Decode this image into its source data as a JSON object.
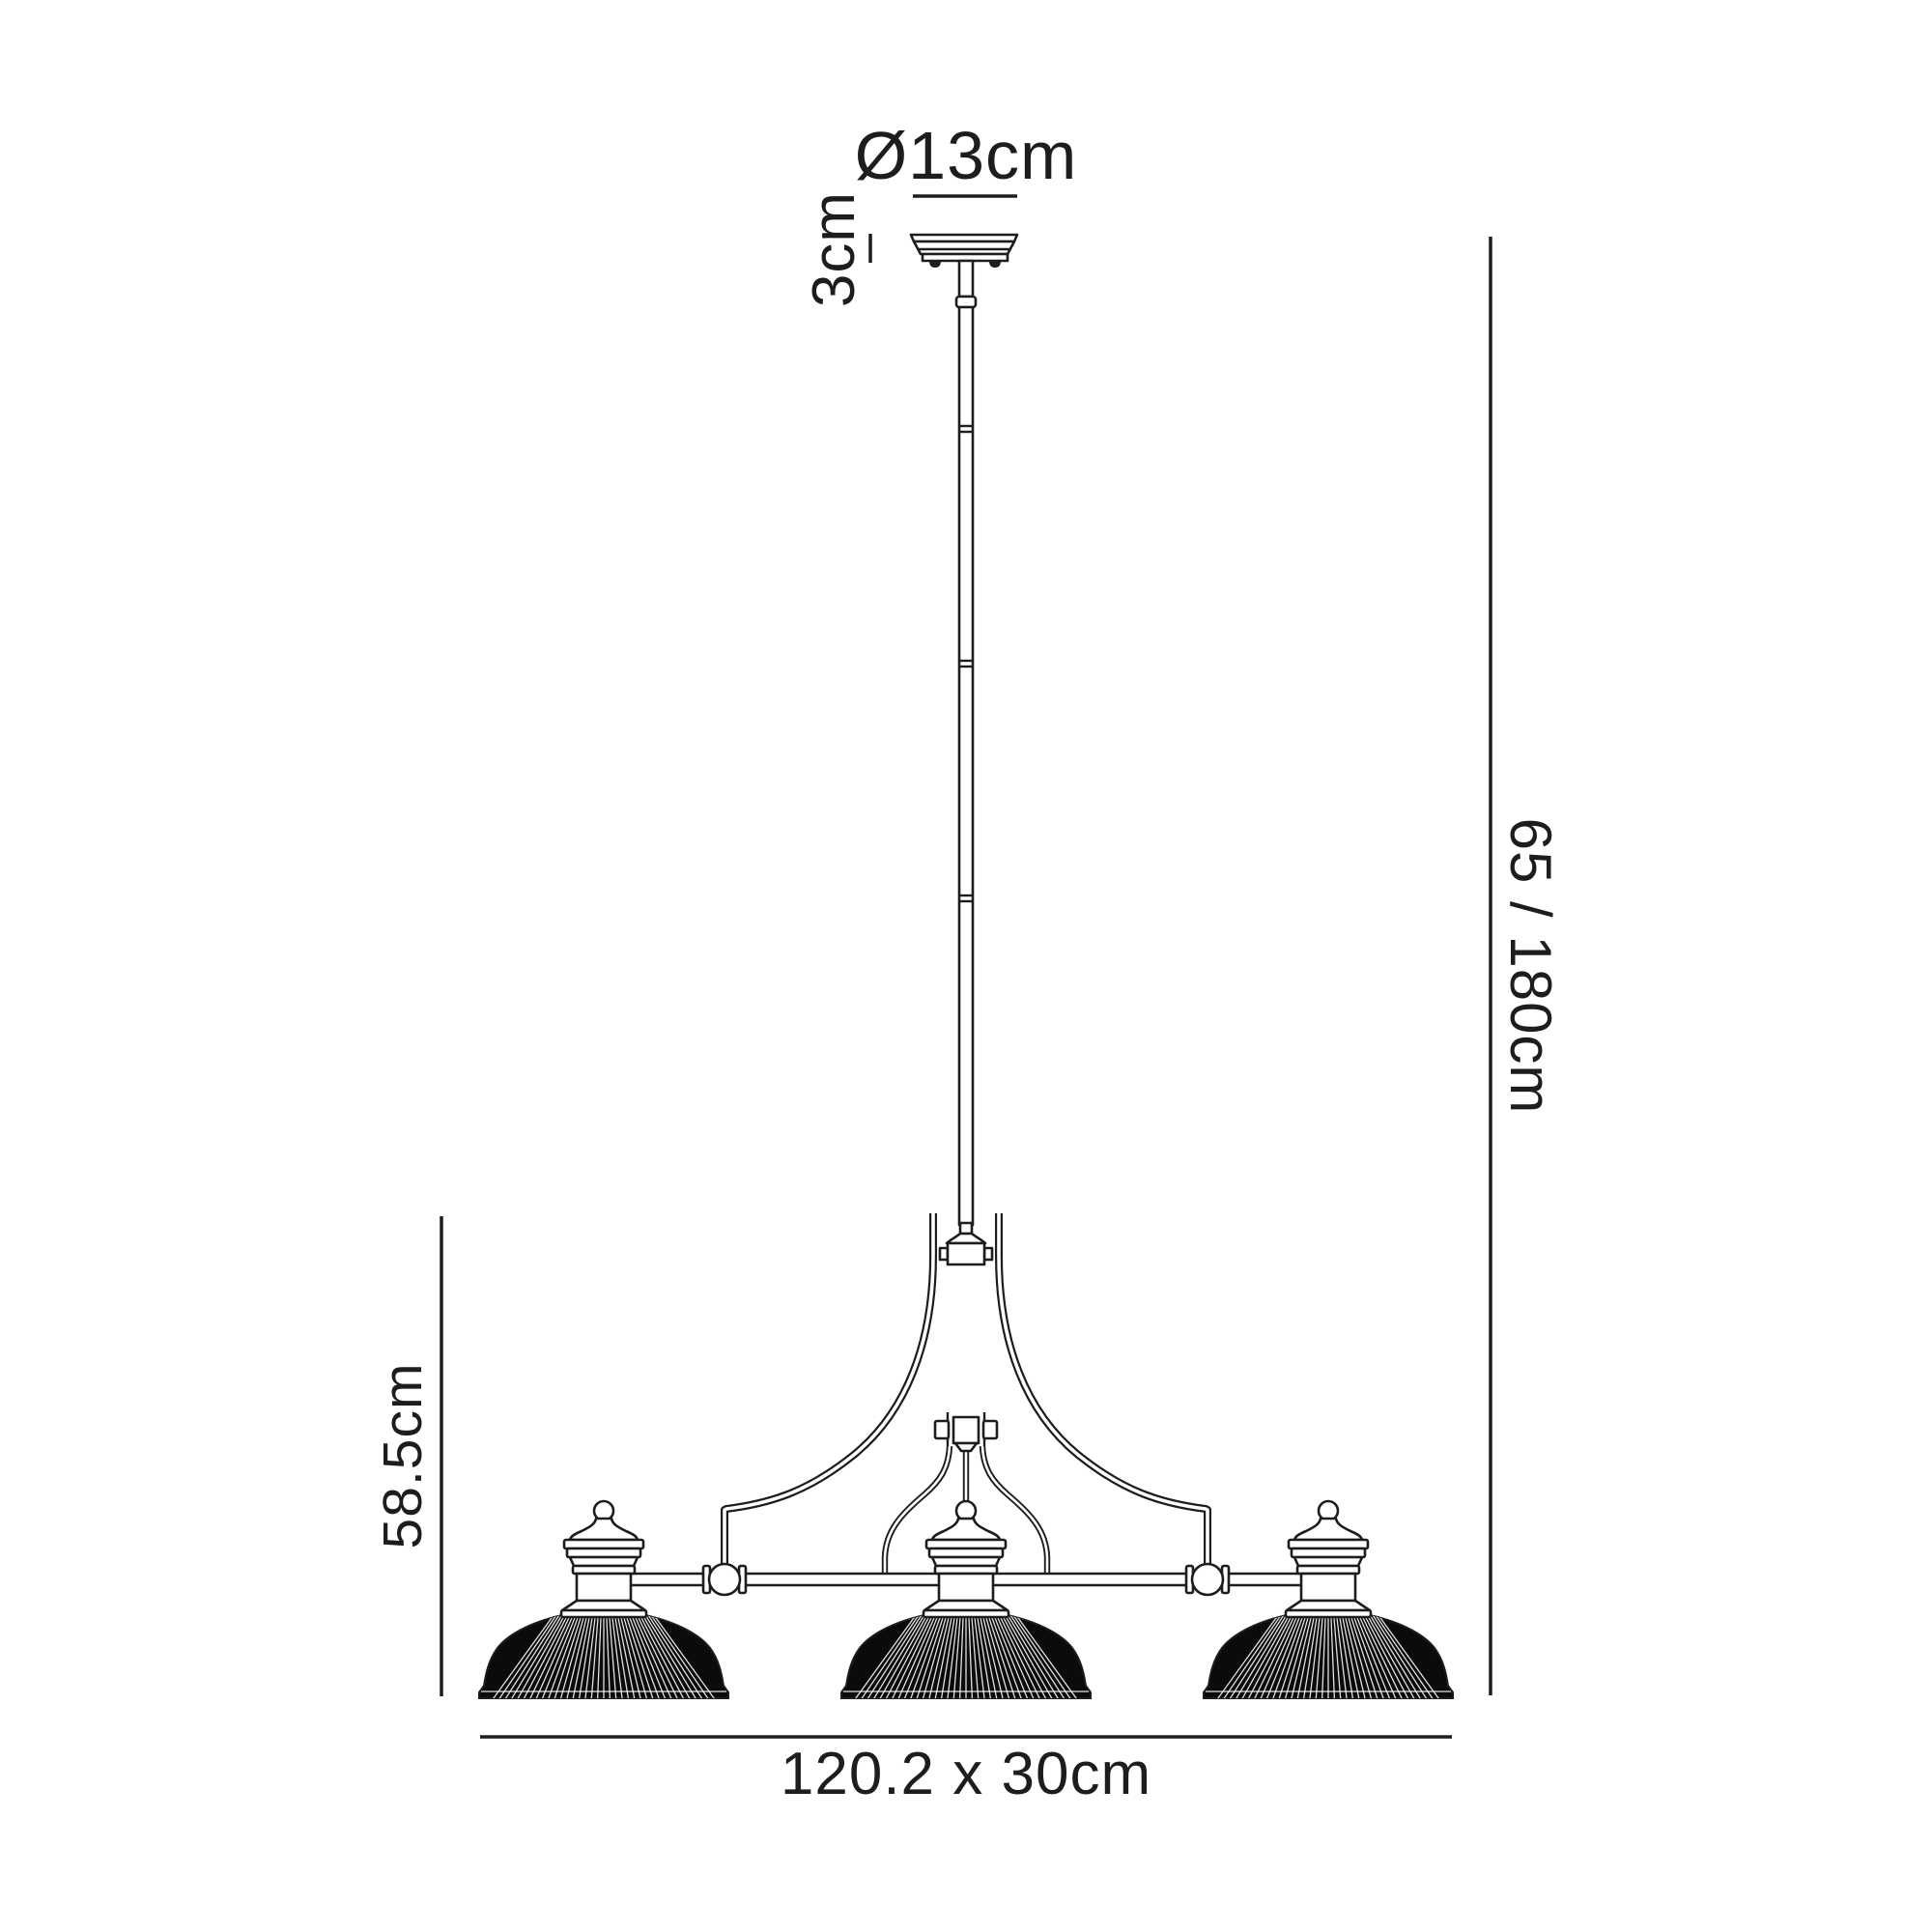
{
  "colors": {
    "background": "#ffffff",
    "ink": "#1d1d1b",
    "shade_fill": "#0b0b0b",
    "rib_line": "#ffffff"
  },
  "annotations": {
    "canopy_diameter": "Ø13cm",
    "canopy_height": "3cm",
    "suspension_drop": "65 / 180cm",
    "body_height": "58.5cm",
    "overall_size": "120.2 x 30cm"
  }
}
